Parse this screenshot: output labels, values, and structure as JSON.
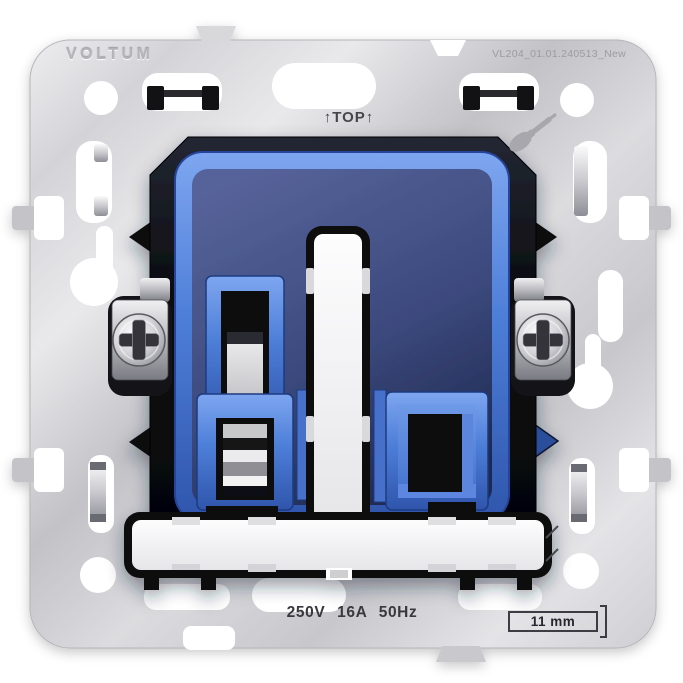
{
  "product": {
    "brand": "VOLTUM",
    "part_number": "VL204_01.01.240513_New",
    "orientation_label": "↑TOP↑",
    "electrical_rating": "250V 16A 50Hz",
    "depth_dimension": "11 mm"
  },
  "icons": {
    "screwdriver": "screwdriver-icon",
    "screw_heads": "phillips-cross-icon",
    "orientation_arrows": "up-arrow-glyphs"
  },
  "colors": {
    "background": "#ffffff",
    "plate_silver": "#cdcdd2",
    "accent_blue": "#4d7ed8",
    "body_navy": "#3c4a7e",
    "housing_black": "#0b0c0e",
    "etched_text": "#3a3a40"
  }
}
